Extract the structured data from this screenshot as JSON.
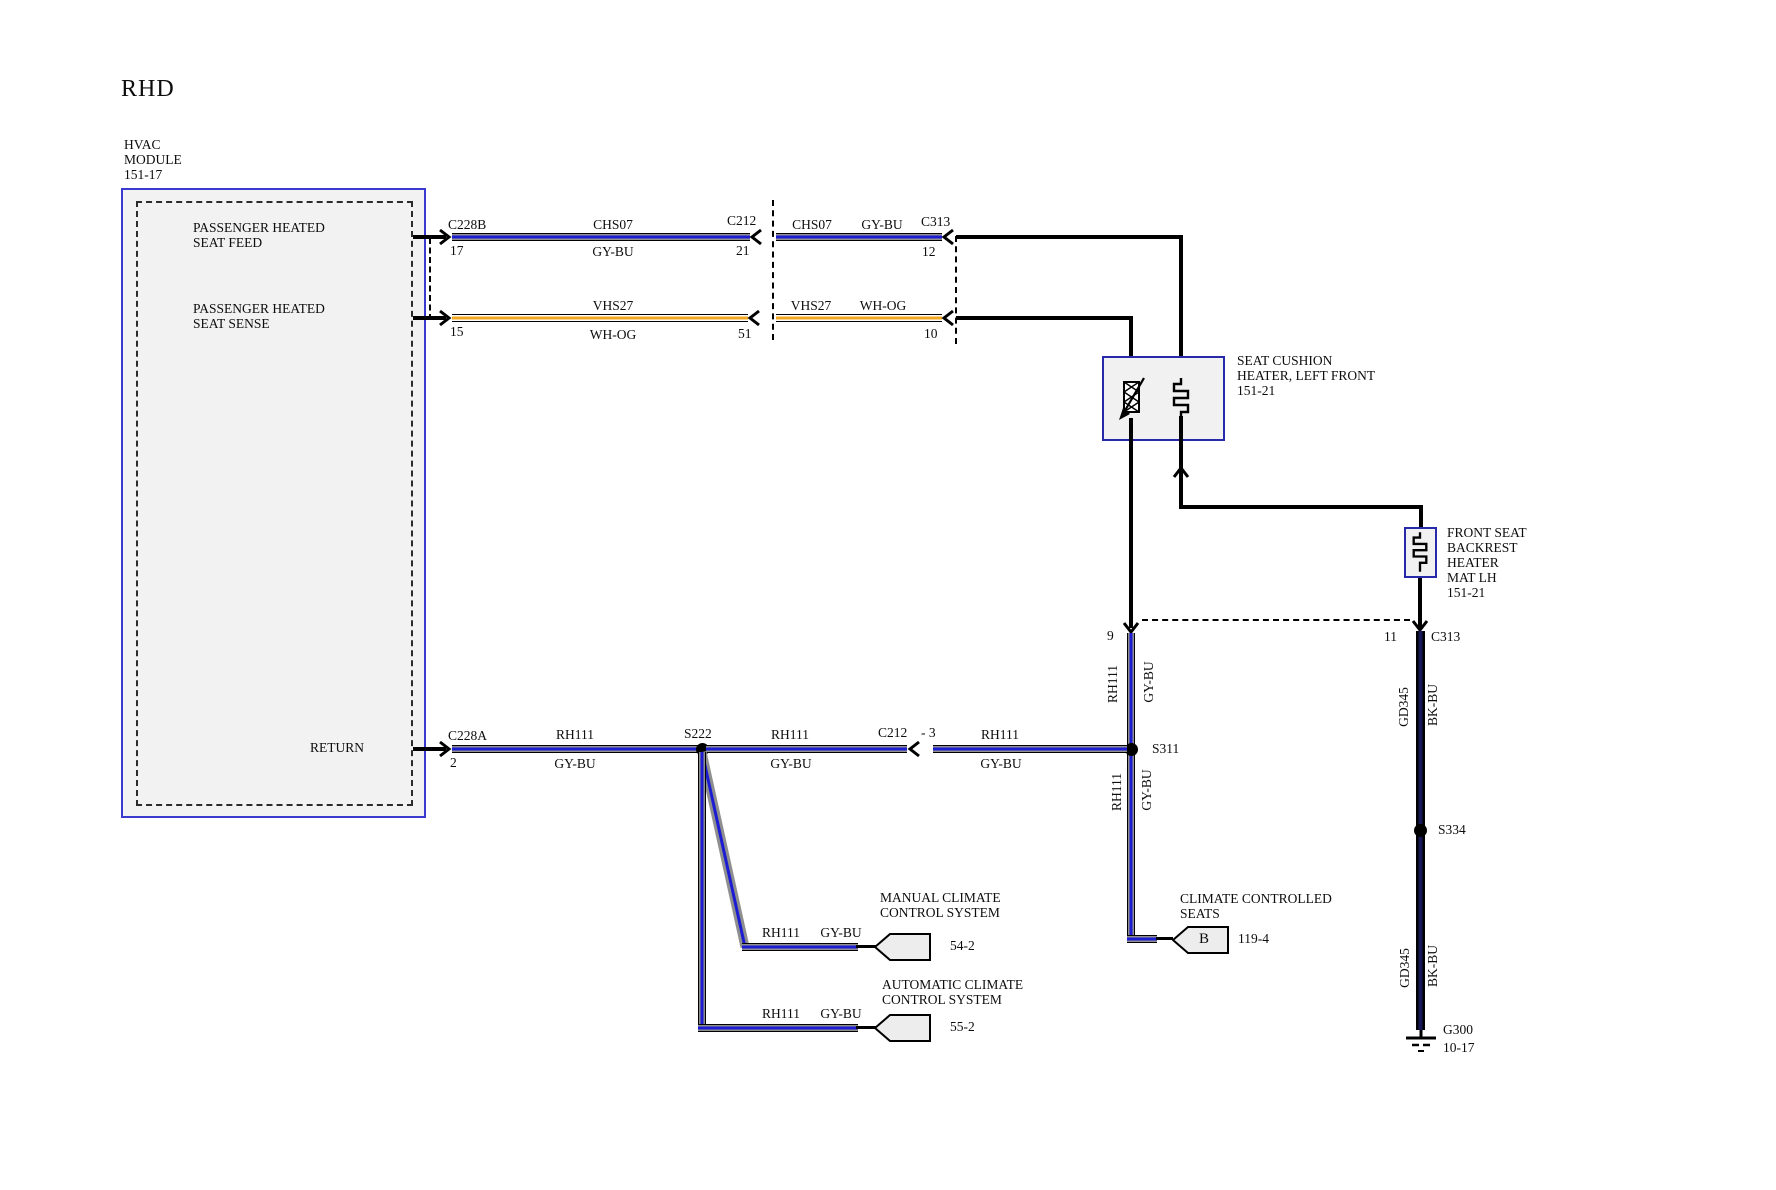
{
  "title": "RHD",
  "colors": {
    "wire_blue": "#1c1cd2",
    "wire_gray": "#8f8f8f",
    "wire_orange": "#f3a71f",
    "wire_navy": "#171757",
    "module_border_blue": "#3a3ad0",
    "component_border_blue": "#2828aa",
    "box_fill": "#f1f1f1",
    "flag_fill": "#ededed"
  },
  "module": {
    "name": [
      "HVAC",
      "MODULE",
      "151-17"
    ],
    "feed": [
      "PASSENGER HEATED",
      "SEAT FEED"
    ],
    "sense": [
      "PASSENGER HEATED",
      "SEAT SENSE"
    ],
    "return": "RETURN"
  },
  "feed": {
    "c1": "C228B",
    "p1": "17",
    "w1": "CHS07",
    "col1": "GY-BU",
    "c2": "C212",
    "p2": "21",
    "w2": "CHS07",
    "col2": "GY-BU",
    "c3": "C313",
    "p3": "12"
  },
  "sense": {
    "p1": "15",
    "w1": "VHS27",
    "col1": "WH-OG",
    "p2": "51",
    "w2": "VHS27",
    "col2": "WH-OG",
    "p3": "10"
  },
  "ret": {
    "c1": "C228A",
    "p1": "2",
    "w1": "RH111",
    "col1": "GY-BU",
    "splice": "S222",
    "w2": "RH111",
    "col2": "GY-BU",
    "c2": "C212",
    "p2": "- 3",
    "w3": "RH111",
    "col3": "GY-BU"
  },
  "cushion": {
    "name": [
      "SEAT CUSHION",
      "HEATER, LEFT FRONT",
      "151-21"
    ]
  },
  "backrest": {
    "name": [
      "FRONT SEAT",
      "BACKREST",
      "HEATER",
      "MAT LH",
      "151-21"
    ]
  },
  "c313_bottom": {
    "p_left": "9",
    "p_right": "11",
    "name": "C313"
  },
  "drop_left": {
    "w1": "RH111",
    "c1": "GY-BU",
    "splice": "S311",
    "w2": "RH111",
    "c2": "GY-BU"
  },
  "drop_right": {
    "w1": "GD345",
    "c1": "BK-BU",
    "splice": "S334",
    "w2": "GD345",
    "c2": "BK-BU",
    "ground": "G300",
    "ground_page": "10-17"
  },
  "manual": {
    "name": [
      "MANUAL CLIMATE",
      "CONTROL SYSTEM"
    ],
    "w": "RH111",
    "c": "GY-BU",
    "page": "54-2"
  },
  "auto": {
    "name": [
      "AUTOMATIC CLIMATE",
      "CONTROL SYSTEM"
    ],
    "w": "RH111",
    "c": "GY-BU",
    "page": "55-2"
  },
  "ccs": {
    "name": [
      "CLIMATE CONTROLLED",
      "SEATS"
    ],
    "pin": "B",
    "page": "119-4"
  }
}
